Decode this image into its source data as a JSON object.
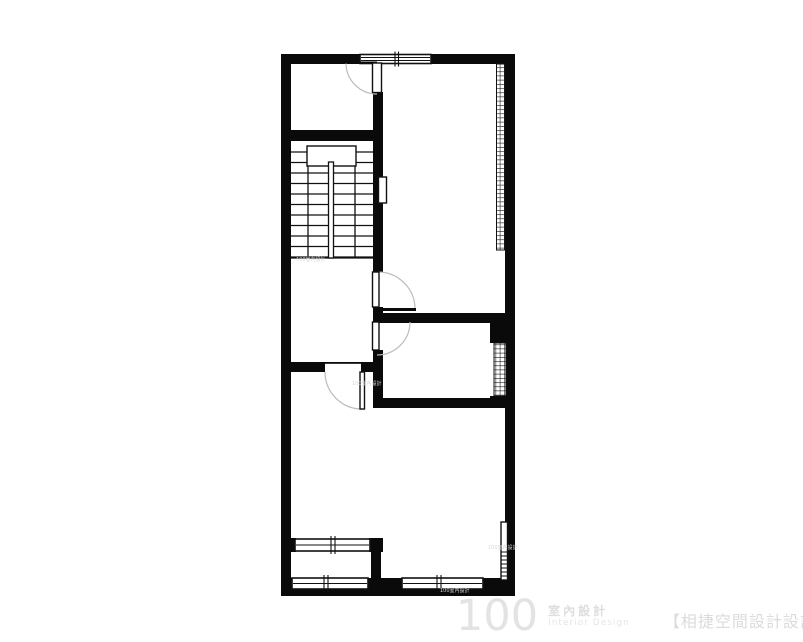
{
  "watermark": {
    "logo_number": "100",
    "logo_title_zh": "室內設計",
    "logo_subtitle_en": "Interior Design",
    "studio_credit": "【相捷空間設計設計事務所】",
    "micro_text": "100室內設計"
  },
  "colors": {
    "background": "#ffffff",
    "wall": "#0a0a0a",
    "ink": "#111111",
    "door_arc": "#bcbcbc",
    "watermark_gray": "#e0e0e0"
  },
  "floor_plan": {
    "canvas": {
      "w": 803,
      "h": 642
    },
    "walls": [
      {
        "name": "left-exterior-wall",
        "r": [
          281,
          54,
          10,
          542
        ]
      },
      {
        "name": "top-exterior-wall-left",
        "r": [
          281,
          54,
          81,
          10
        ]
      },
      {
        "name": "top-exterior-wall-right",
        "r": [
          430,
          54,
          85,
          10
        ]
      },
      {
        "name": "right-exterior-wall",
        "r": [
          505,
          54,
          10,
          542
        ]
      },
      {
        "name": "bottom-exterior-wall",
        "r": [
          281,
          578,
          234,
          18
        ]
      },
      {
        "name": "front-room-bottom-wall",
        "r": [
          281,
          130,
          102,
          11
        ]
      },
      {
        "name": "center-vertical-wall-upper",
        "r": [
          373,
          92,
          10,
          180
        ]
      },
      {
        "name": "center-wall-between-doors",
        "r": [
          373,
          307,
          10,
          16
        ]
      },
      {
        "name": "bedroom-divider-wall",
        "r": [
          373,
          313,
          132,
          10
        ]
      },
      {
        "name": "middle-room-corner-chunk",
        "r": [
          490,
          323,
          25,
          20
        ]
      },
      {
        "name": "center-vertical-wall-lower",
        "r": [
          373,
          350,
          10,
          58
        ]
      },
      {
        "name": "middle-room-bottom-wall",
        "r": [
          373,
          398,
          142,
          10
        ]
      },
      {
        "name": "middle-room-lower-chunk",
        "r": [
          490,
          396,
          25,
          12
        ]
      },
      {
        "name": "hall-bottom-wall-left",
        "r": [
          281,
          362,
          44,
          10
        ]
      },
      {
        "name": "hall-bottom-wall-right",
        "r": [
          361,
          362,
          22,
          10
        ]
      },
      {
        "name": "balcony-wall-left-seg",
        "r": [
          281,
          538,
          15,
          14
        ]
      },
      {
        "name": "balcony-wall-right-seg",
        "r": [
          369,
          538,
          14,
          14
        ]
      },
      {
        "name": "balcony-right-wall",
        "r": [
          371,
          552,
          10,
          26
        ]
      }
    ],
    "stairs": {
      "x1": 288,
      "x2": 373,
      "tread_ys": [
        152,
        162.5,
        173,
        183.5,
        194,
        204.5,
        215,
        225.5,
        236,
        246.5,
        257
      ],
      "vlines": [
        [
          308,
          146,
          258
        ],
        [
          355,
          146,
          258
        ]
      ],
      "bottom_line": [
        288,
        258,
        373,
        258
      ],
      "landing": {
        "name": "stair-landing",
        "r": [
          307,
          146,
          49,
          20
        ]
      },
      "rail": {
        "name": "stair-center-rail",
        "r": [
          328.5,
          162,
          5,
          96
        ]
      }
    },
    "hatches": [
      {
        "name": "bedroom-wardrobe-hatch",
        "r": [
          496.5,
          64,
          8.5,
          186
        ]
      },
      {
        "name": "middle-room-wardrobe-hatch",
        "r": [
          494,
          343,
          12,
          53
        ]
      }
    ],
    "windows": [
      {
        "name": "top-window",
        "r": [
          360,
          54.5,
          71,
          9
        ],
        "lines": [
          57.5,
          60.5
        ],
        "ticks": [
          395,
          398.5
        ]
      },
      {
        "name": "balcony-inner-window",
        "r": [
          295,
          539,
          75,
          12
        ],
        "lines": [
          545
        ],
        "ticks": [
          331,
          335
        ]
      },
      {
        "name": "bottom-window-left",
        "r": [
          292,
          578,
          76,
          11
        ],
        "lines": [
          583.5
        ],
        "ticks": [
          324,
          328
        ]
      },
      {
        "name": "bottom-window-right",
        "r": [
          402,
          578,
          81,
          11
        ],
        "lines": [
          583.5
        ],
        "ticks": [
          437,
          441
        ]
      }
    ],
    "fixtures": [
      {
        "name": "stair-wall-niche",
        "r": [
          378.5,
          177,
          8,
          26
        ]
      },
      {
        "name": "right-wall-vent-strip",
        "r": [
          501,
          522,
          6.5,
          58
        ],
        "rungs": [
          552,
          556,
          560,
          564,
          568,
          572,
          576
        ]
      }
    ],
    "doors": [
      {
        "name": "front-room-door",
        "arc": "M 346 63 A 31 31 0 0 0 377 94",
        "leaf": [
          372.5,
          63,
          9,
          29.5
        ],
        "header": [
          340,
          61.5,
          37,
          2
        ]
      },
      {
        "name": "bedroom-door",
        "arc": "M 378 272 A 37 37 0 0 1 415 309",
        "leaf": [
          372.5,
          272,
          6.5,
          35
        ],
        "open_leaf": [
          379,
          308,
          37,
          3
        ]
      },
      {
        "name": "middle-room-door",
        "arc": "M 410 322 A 33 33 0 0 1 377 355",
        "leaf": [
          372.5,
          322,
          6.5,
          28
        ]
      },
      {
        "name": "hall-door",
        "arc": "M 325 372 A 37 37 0 0 0 362 409",
        "leaf": [
          360,
          372,
          4.5,
          37
        ],
        "header": [
          325,
          362,
          36,
          1.8
        ]
      }
    ],
    "micro_watermarks": [
      {
        "x": 440,
        "y": 589
      },
      {
        "x": 296,
        "y": 258
      },
      {
        "x": 352,
        "y": 382
      },
      {
        "x": 488,
        "y": 546
      }
    ]
  }
}
